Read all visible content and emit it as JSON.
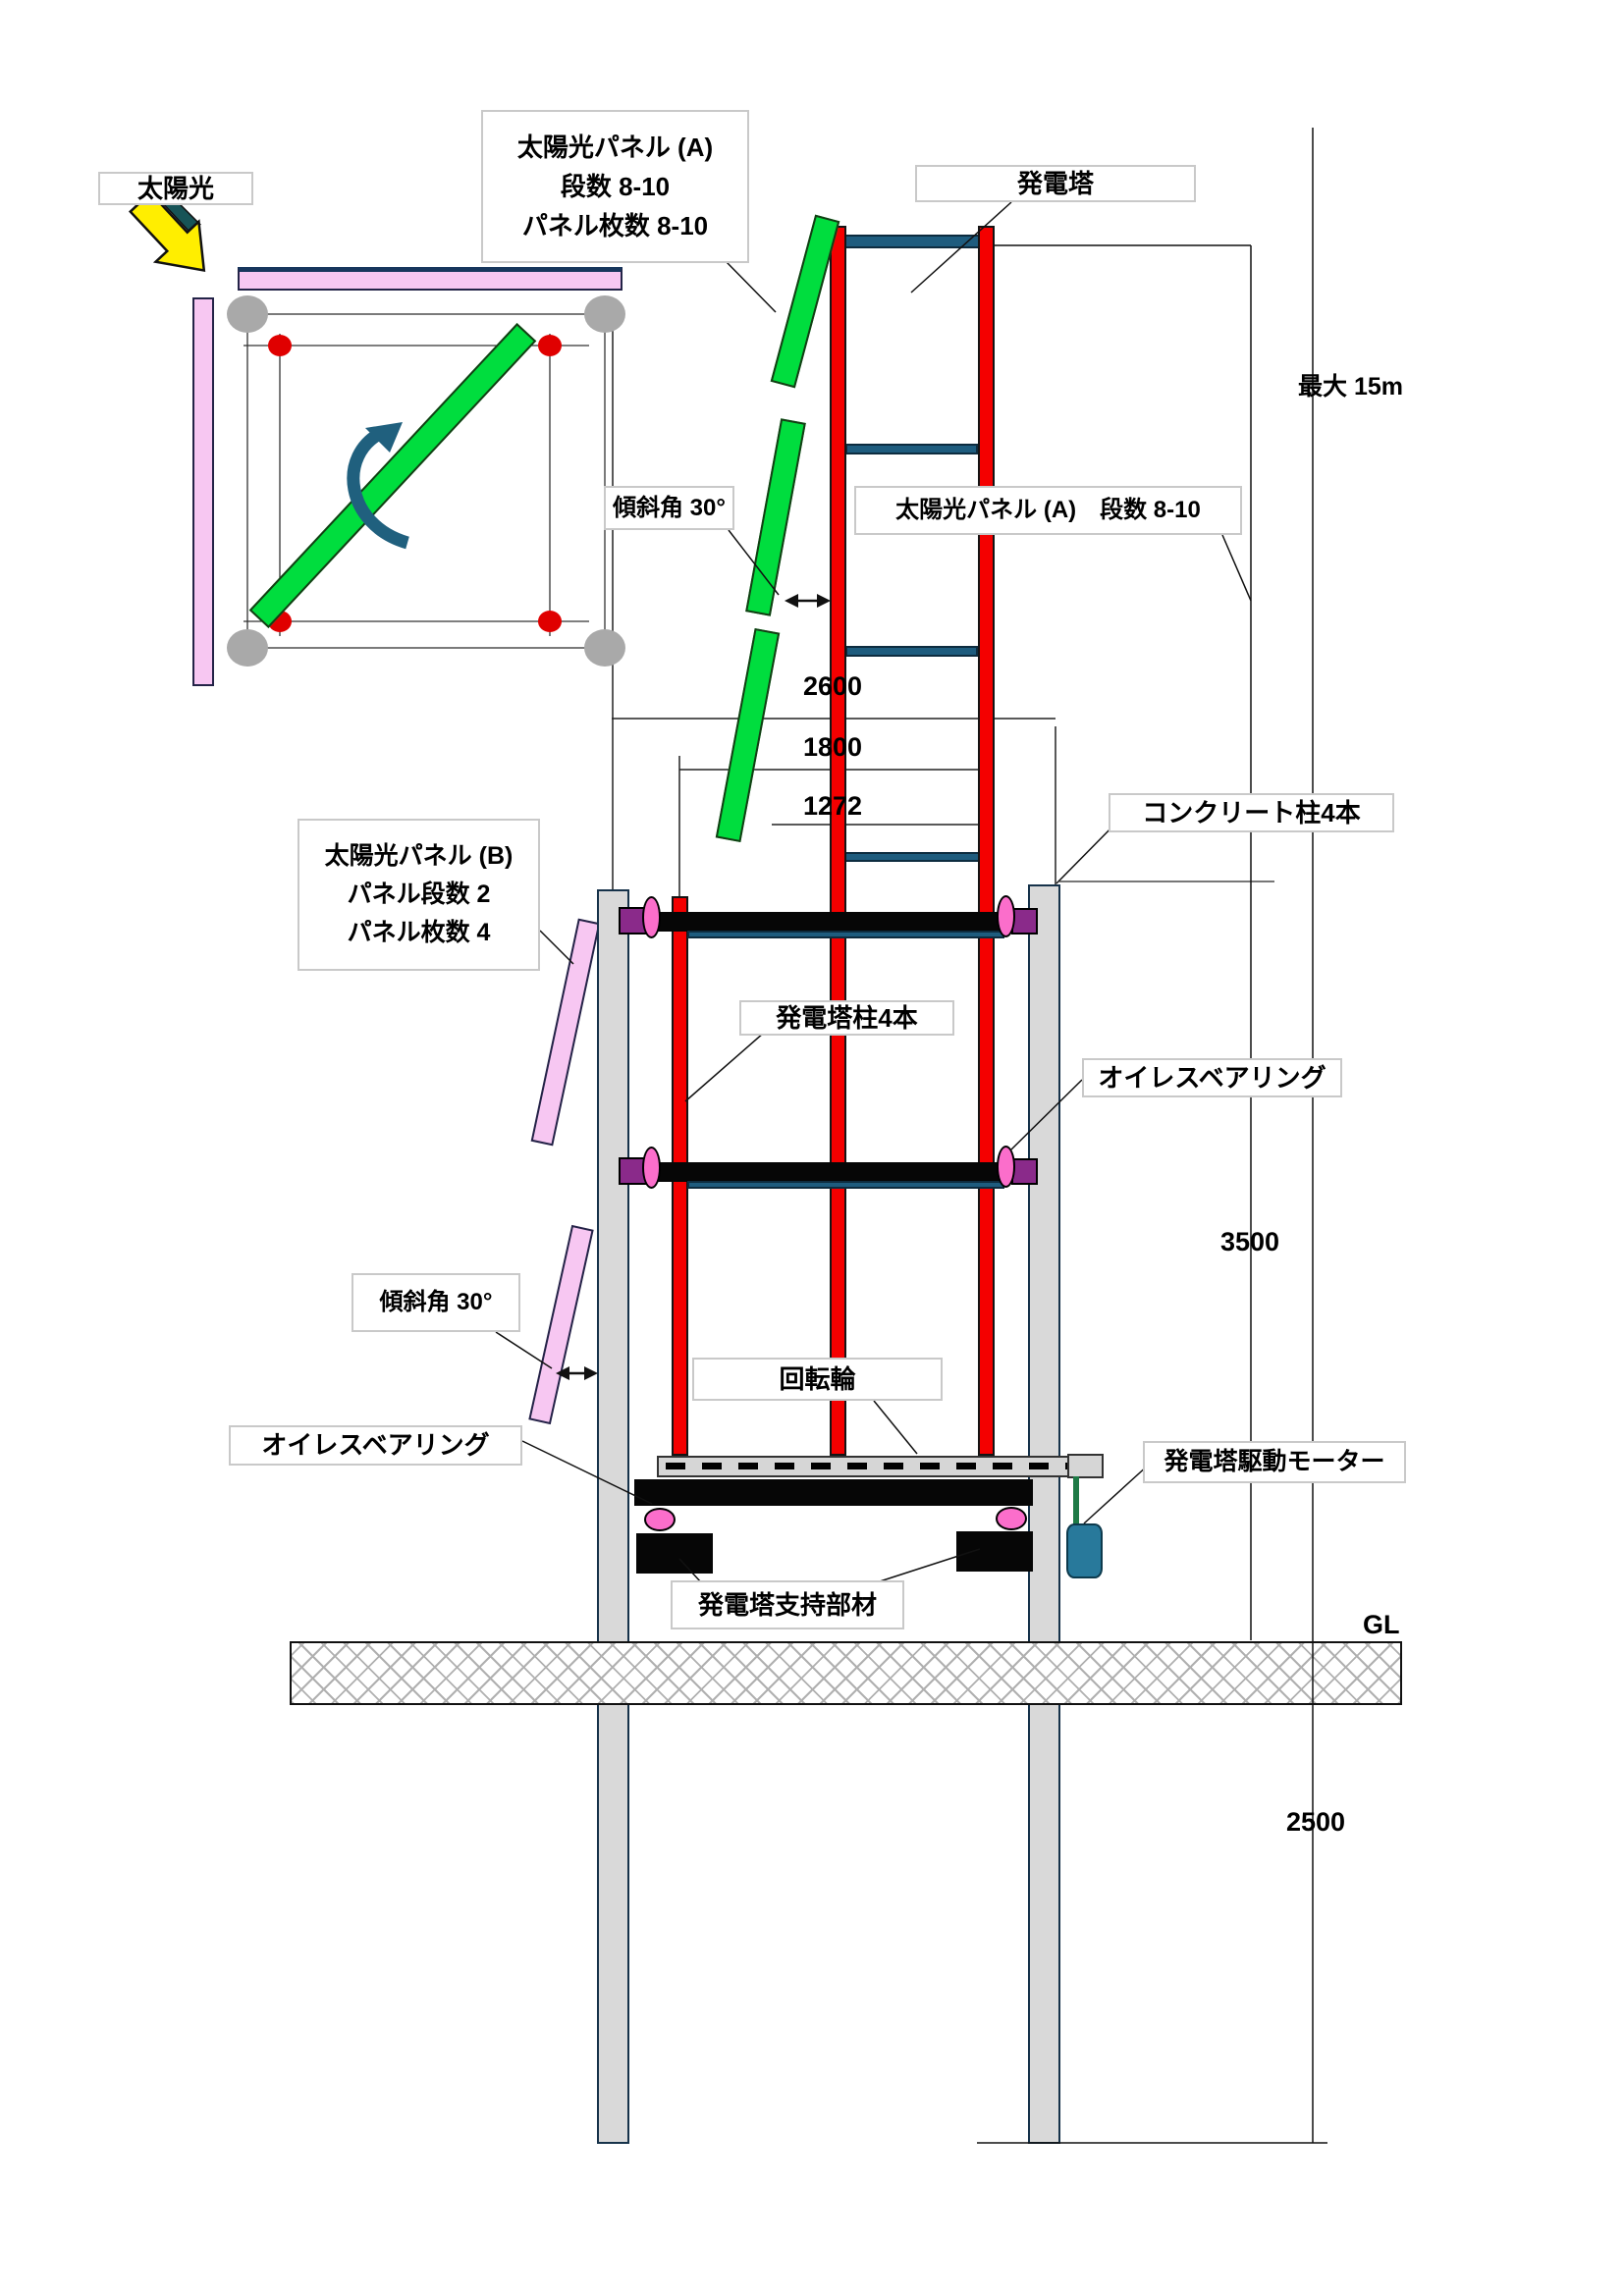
{
  "plan": {
    "sun": "太陽光"
  },
  "labels": {
    "panel_a_top": {
      "l1": "太陽光パネル (A)",
      "l2": "段数 8-10",
      "l3": "パネル枚数 8-10"
    },
    "tower": "発電塔",
    "panel_a_mid": "太陽光パネル (A)　段数 8-10",
    "tilt_upper": "傾斜角 30°",
    "panel_b": {
      "l1": "太陽光パネル (B)",
      "l2": "パネル段数 2",
      "l3": "パネル枚数 4"
    },
    "concrete_cols": "コンクリート柱4本",
    "tower_cols": "発電塔柱4本",
    "bearing_upper": "オイレスベアリング",
    "tilt_lower": "傾斜角 30°",
    "bearing_lower": "オイレスベアリング",
    "wheel": "回転輪",
    "support": "発電塔支持部材",
    "motor": "発電塔駆動モーター"
  },
  "dims": {
    "span_top": "2600",
    "span_mid": "1800",
    "span_low": "1272",
    "height_mid": "3500",
    "depth": "2500",
    "max_height": "最大 15m",
    "ground_level": "GL"
  },
  "colors": {
    "tower_column_red": "#f40000",
    "beam_teal": "#1e5c7e",
    "panel_green": "#00dd3e",
    "panel_pink": "#f7c7f2",
    "bearing_pink": "#fb6ecb",
    "bearing_purple": "#8a2a8a",
    "concrete_gray": "#d9d9d9",
    "motor_teal": "#28799b",
    "sun_arrow_yellow": "#ffee00",
    "rotation_arrow_teal": "#20607e"
  }
}
